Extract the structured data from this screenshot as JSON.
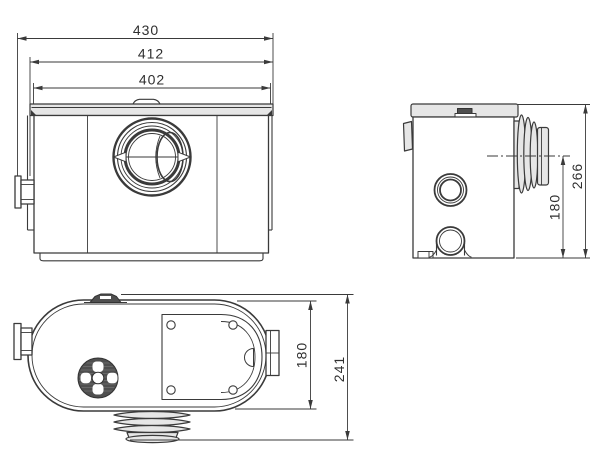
{
  "drawing": {
    "views": {
      "front": {
        "label": "front-view",
        "dims": {
          "overall_width": "430",
          "flange_width": "412",
          "body_width": "402"
        }
      },
      "side": {
        "label": "side-view",
        "dims": {
          "outlet_center_height": "180",
          "overall_height": "266"
        }
      },
      "top": {
        "label": "top-view",
        "dims": {
          "body_depth": "180",
          "overall_depth": "241"
        }
      }
    },
    "colors": {
      "line": "#3a3a3a",
      "light_fill": "#e6e6e6",
      "dark_fill": "#4f4f4f",
      "background": "#ffffff"
    }
  }
}
